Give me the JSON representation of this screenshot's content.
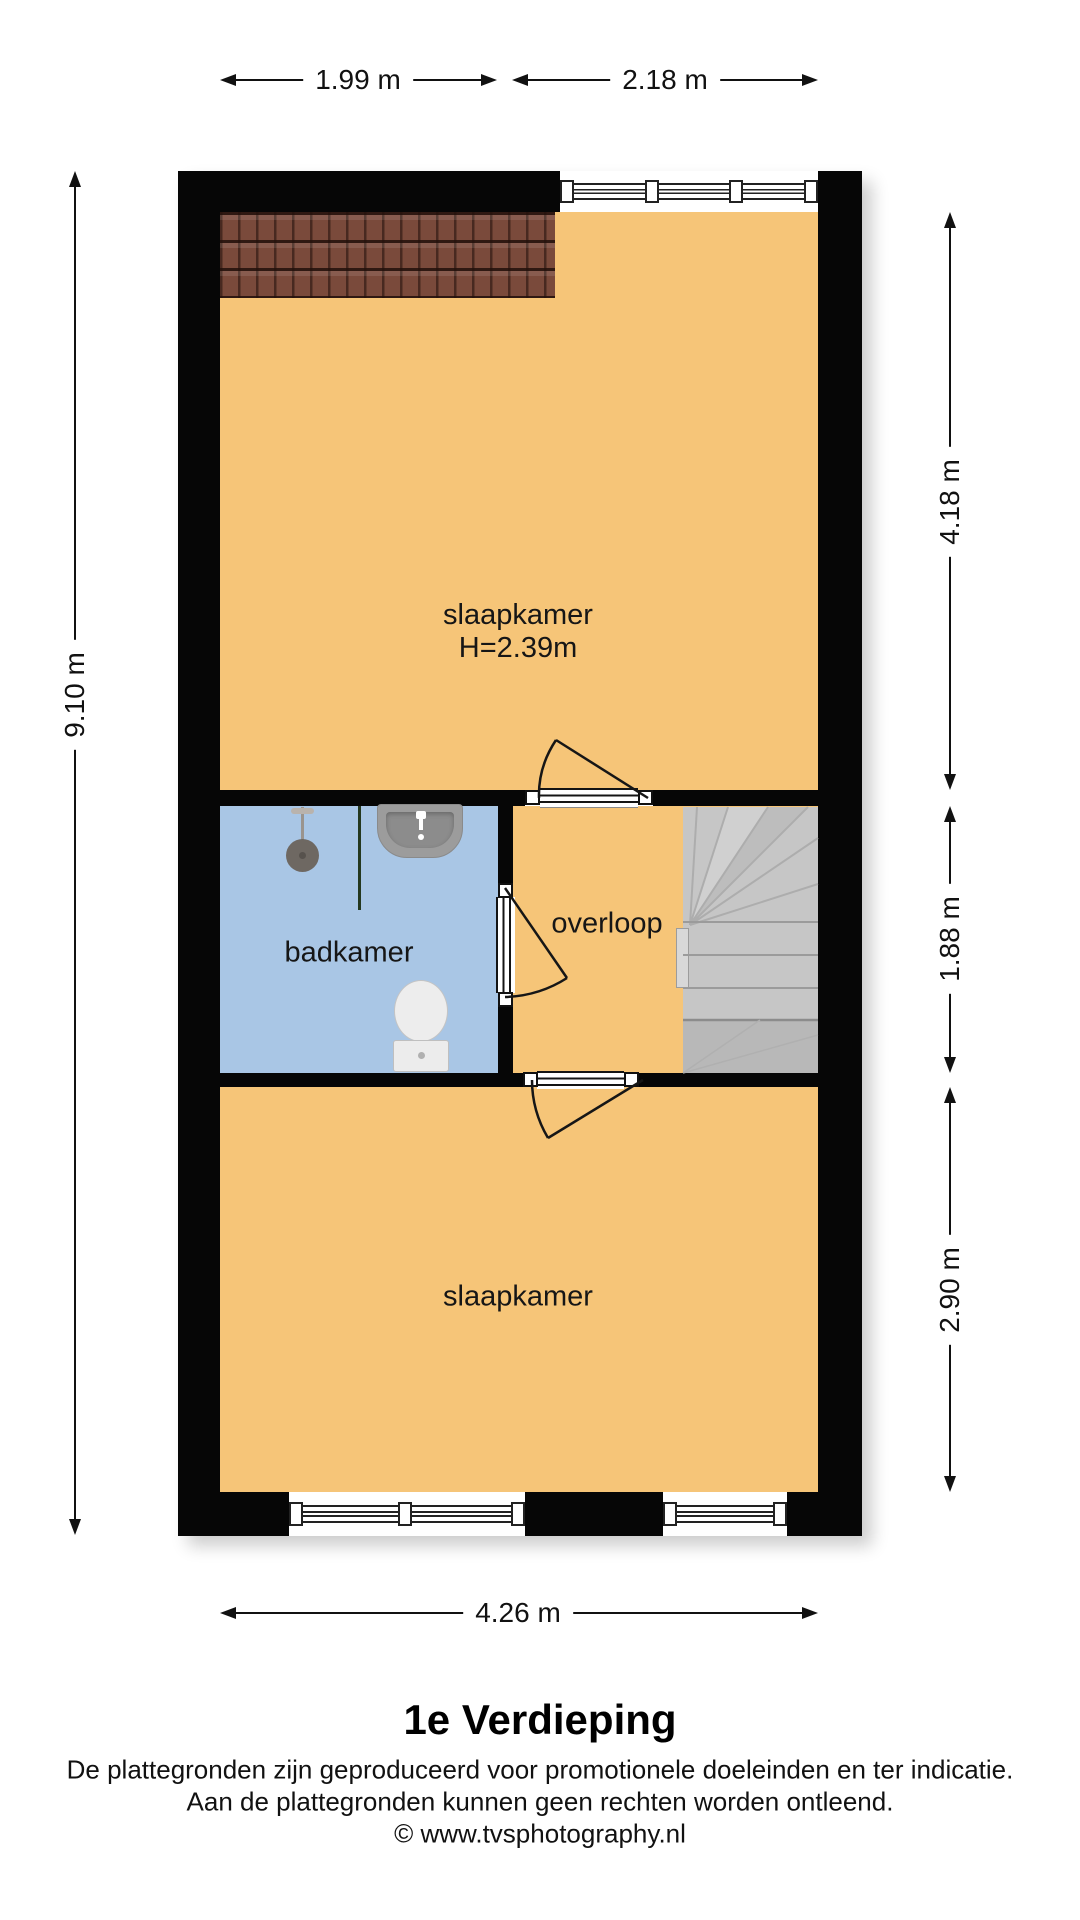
{
  "plan": {
    "dimensions": {
      "top_left": "1.99 m",
      "top_right": "2.18 m",
      "left": "9.10 m",
      "right_top": "4.18 m",
      "right_middle": "1.88 m",
      "right_bottom": "2.90 m",
      "bottom": "4.26 m"
    },
    "rooms": {
      "bedroom_top": {
        "label": "slaapkamer",
        "ceiling_height": "H=2.39m"
      },
      "bathroom": {
        "label": "badkamer"
      },
      "landing": {
        "label": "overloop"
      },
      "bedroom_bottom": {
        "label": "slaapkamer"
      }
    }
  },
  "footer": {
    "title": "1e Verdieping",
    "disclaimer_line1": "De plattegronden zijn geproduceerd voor promotionele doeleinden en ter indicatie.",
    "disclaimer_line2": "Aan de plattegronden kunnen geen rechten worden ontleend.",
    "copyright": "© www.tvsphotography.nl"
  },
  "colors": {
    "floor": "#F6C578",
    "bathroom_floor": "#A9C6E5",
    "wall": "#060606",
    "stairs": "#C6C6C6",
    "roof_tiles": "#7A4A3B"
  }
}
